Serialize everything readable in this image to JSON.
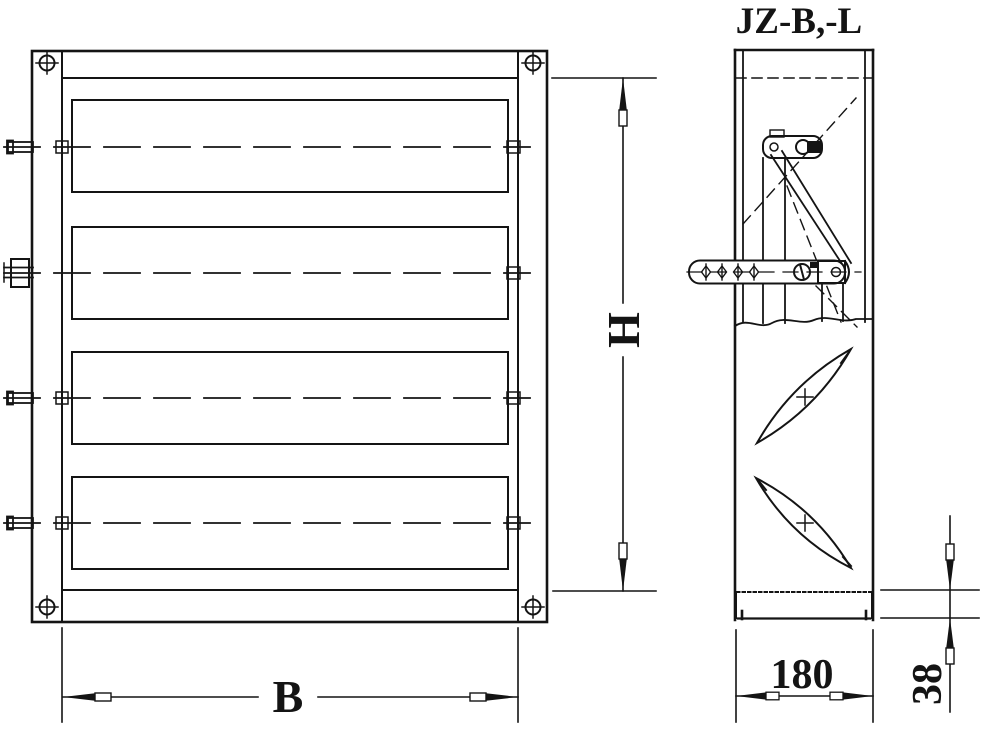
{
  "drawing": {
    "title": "JZ-B,-L",
    "labels": {
      "height": "H",
      "width": "B",
      "depth": "180",
      "flange": "38"
    },
    "colors": {
      "line": "#141414",
      "background": "#ffffff"
    }
  }
}
